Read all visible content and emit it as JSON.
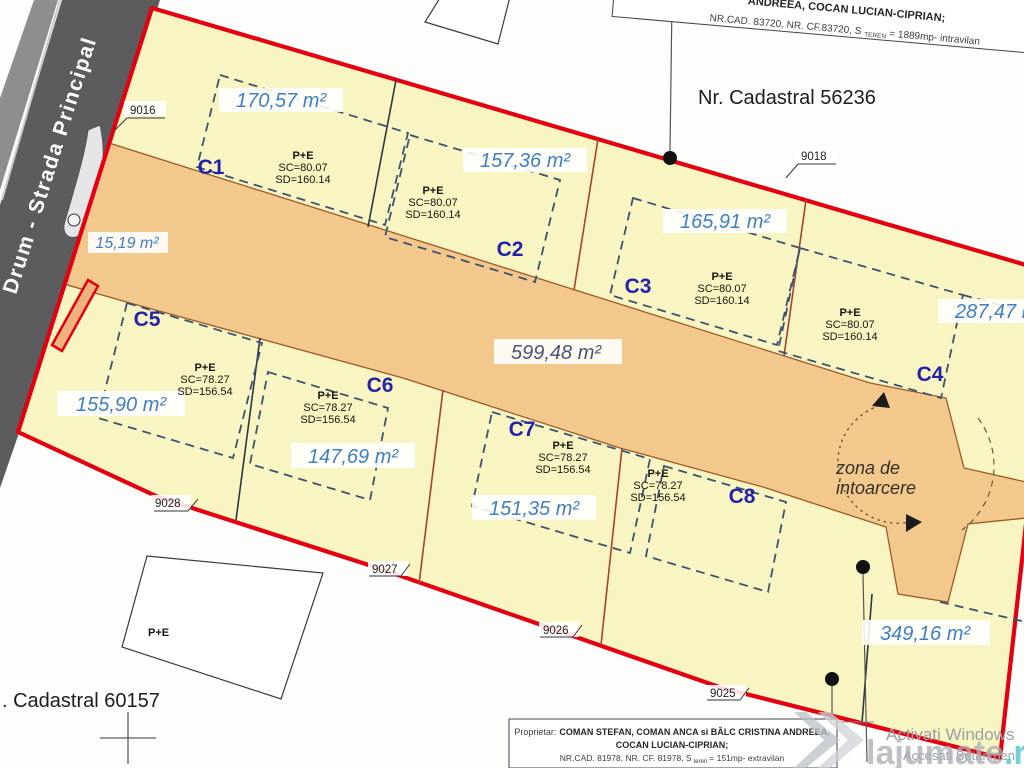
{
  "plan": {
    "street_label": "Drum - Strada Principal",
    "cadastral_right": "Nr. Cadastral 56236",
    "cadastral_left": ". Cadastral 60157",
    "access_area": "599,48 m²",
    "entrance_area": "15,19 m²",
    "corner_area": "349,16 m²",
    "turning_zone_line1": "zona de",
    "turning_zone_line2": "intoarcere",
    "neighbor_building": "P+E",
    "points": {
      "p9016": "9016",
      "p9018": "9018",
      "p9025": "9025",
      "p9026": "9026",
      "p9027": "9027",
      "p9028": "9028"
    },
    "parcels": [
      {
        "id": "C1",
        "area": "170,57 m²",
        "regime": "P+E",
        "sc": "SC=80.07",
        "sd": "SD=160.14"
      },
      {
        "id": "C2",
        "area": "157,36 m²",
        "regime": "P+E",
        "sc": "SC=80.07",
        "sd": "SD=160.14"
      },
      {
        "id": "C3",
        "area": "165,91 m²",
        "regime": "P+E",
        "sc": "SC=80.07",
        "sd": "SD=160.14"
      },
      {
        "id": "C4",
        "area": "287,47 m²",
        "regime": "P+E",
        "sc": "SC=80.07",
        "sd": "SD=160.14"
      },
      {
        "id": "C5",
        "area": "155,90 m²",
        "regime": "P+E",
        "sc": "SC=78.27",
        "sd": "SD=156.54"
      },
      {
        "id": "C6",
        "area": "147,69 m²",
        "regime": "P+E",
        "sc": "SC=78.27",
        "sd": "SD=156.54"
      },
      {
        "id": "C7",
        "area": "151,35 m²",
        "regime": "P+E",
        "sc": "SC=78.27",
        "sd": "SD=156.54"
      },
      {
        "id": "C8",
        "area": "",
        "regime": "P+E",
        "sc": "SC=78.27",
        "sd": "SD=156.54"
      }
    ],
    "top_box": {
      "line1": "ANDREEA, COCAN LUCIAN-CIPRIAN;",
      "line2_pre": "NR.CAD. 83720, NR. CF.83720, S",
      "line2_sub": "TEREN",
      "line2_post": "= 1889mp- intravilan"
    },
    "bottom_box": {
      "line1_label": "Proprietar:",
      "line1": "COMAN STEFAN, COMAN ANCA si BĂLC CRISTINA ANDREEA,",
      "line2": "COCAN LUCIAN-CIPRIAN;",
      "line3_pre": "NR.CAD. 81978, NR. CF. 81978, S",
      "line3_sub": "teren",
      "line3_post": "= 151mp- extravilan"
    }
  },
  "overlay": {
    "watermark_main": "lajumate",
    "watermark_tld": ".ro",
    "activate_line1": "Activati Windows",
    "activate_line2": "Accesati Setari pen"
  },
  "colors": {
    "boundary": "#e30010",
    "parcel_fill": "#f9f5c2",
    "access_fill": "#f3c88c",
    "area_label": "#3f7fc4",
    "parcel_id": "#2323a8"
  }
}
